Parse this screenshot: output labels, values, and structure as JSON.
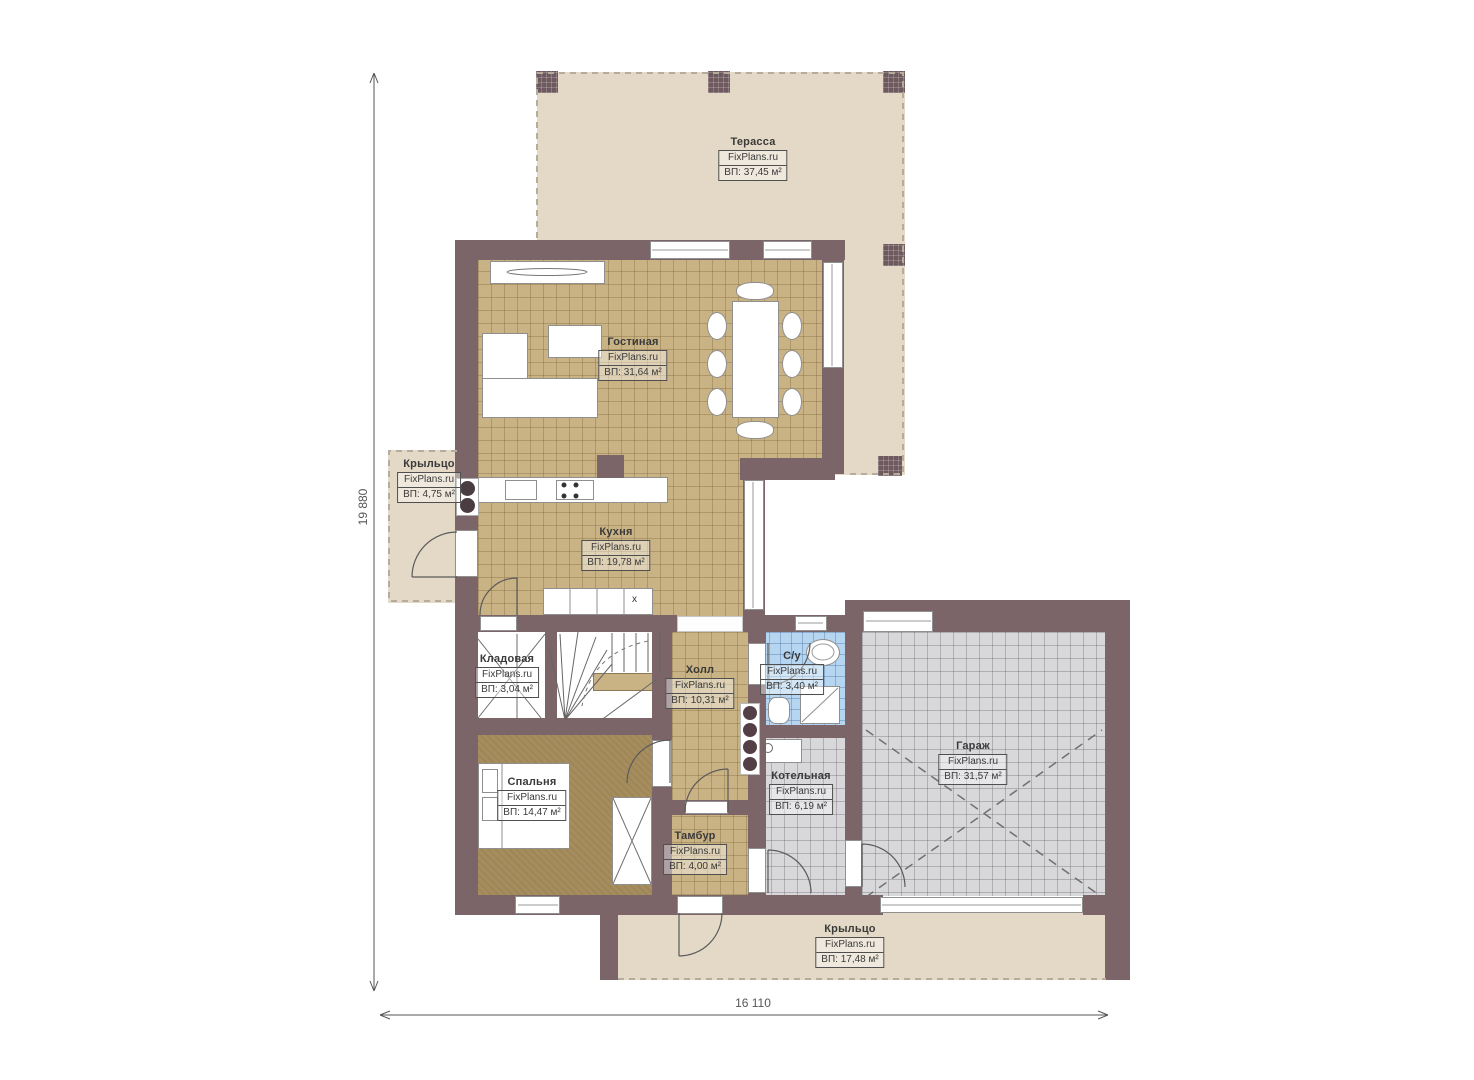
{
  "plan": {
    "brand": "FixPlans.ru",
    "area_label_prefix": "ВП:",
    "dimensions": {
      "vertical": "19 880",
      "horizontal": "16 110"
    },
    "rooms": [
      {
        "id": "terrace",
        "name": "Терасса",
        "area": "ВП: 37,45 м²"
      },
      {
        "id": "living-room",
        "name": "Гостиная",
        "area": "ВП: 31,64 м²"
      },
      {
        "id": "porch-left",
        "name": "Крыльцо",
        "area": "ВП: 4,75 м²"
      },
      {
        "id": "kitchen",
        "name": "Кухня",
        "area": "ВП: 19,78 м²"
      },
      {
        "id": "storage",
        "name": "Кладовая",
        "area": "ВП: 3,04 м²"
      },
      {
        "id": "hall",
        "name": "Холл",
        "area": "ВП: 10,31 м²"
      },
      {
        "id": "bathroom",
        "name": "С/у",
        "area": "ВП: 3,40 м²"
      },
      {
        "id": "garage",
        "name": "Гараж",
        "area": "ВП: 31,57 м²"
      },
      {
        "id": "bedroom",
        "name": "Спальня",
        "area": "ВП: 14,47 м²"
      },
      {
        "id": "boiler-room",
        "name": "Котельная",
        "area": "ВП: 6,19 м²"
      },
      {
        "id": "vestibule",
        "name": "Тамбур",
        "area": "ВП: 4,00 м²"
      },
      {
        "id": "porch-bottom",
        "name": "Крыльцо",
        "area": "ВП: 17,48 м²"
      }
    ],
    "markers": {
      "island": "x"
    },
    "colors": {
      "wall": "#7b6569",
      "terrace_floor": "#e4d9c6",
      "tile_tan": "#c9b385",
      "tile_gray": "#d8d8da",
      "tile_blue": "#b5d5f0",
      "carpet": "#a58d5e"
    }
  }
}
